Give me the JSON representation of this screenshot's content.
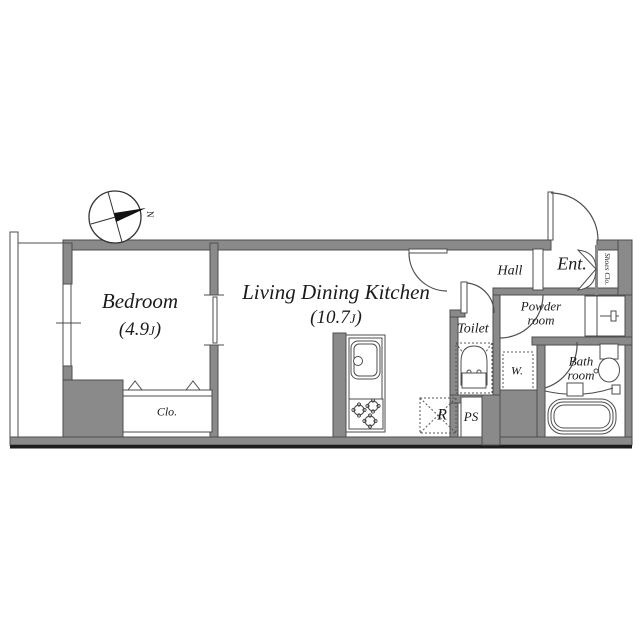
{
  "compass": {
    "north_label": "N"
  },
  "rooms": {
    "bedroom": {
      "name": "Bedroom",
      "size_prefix": "(4.9",
      "size_unit": "J",
      "size_suffix": ")"
    },
    "living_dining_kitchen": {
      "name": "Living Dining Kitchen",
      "size_prefix": "(10.7",
      "size_unit": "J",
      "size_suffix": ")"
    },
    "hall": {
      "name": "Hall"
    },
    "entrance": {
      "name": "Ent."
    },
    "shoes_closet": {
      "name": "Shoes Clo."
    },
    "toilet": {
      "name": "Toilet"
    },
    "powder_room": {
      "name_line1": "Powder",
      "name_line2": "room"
    },
    "bath_room": {
      "name_line1": "Bath",
      "name_line2": "room"
    },
    "closet": {
      "name": "Clo."
    }
  },
  "fixtures": {
    "washing_machine": {
      "label": "W."
    },
    "refrigerator": {
      "label": "R"
    },
    "pipe_space": {
      "label": "PS"
    }
  },
  "colors": {
    "wall_fill": "#8a8a8a",
    "outline": "#4d4d4d",
    "text": "#1b1b1b",
    "bottom_shadow": "#1c1c1c",
    "north_needle": "#111111"
  }
}
